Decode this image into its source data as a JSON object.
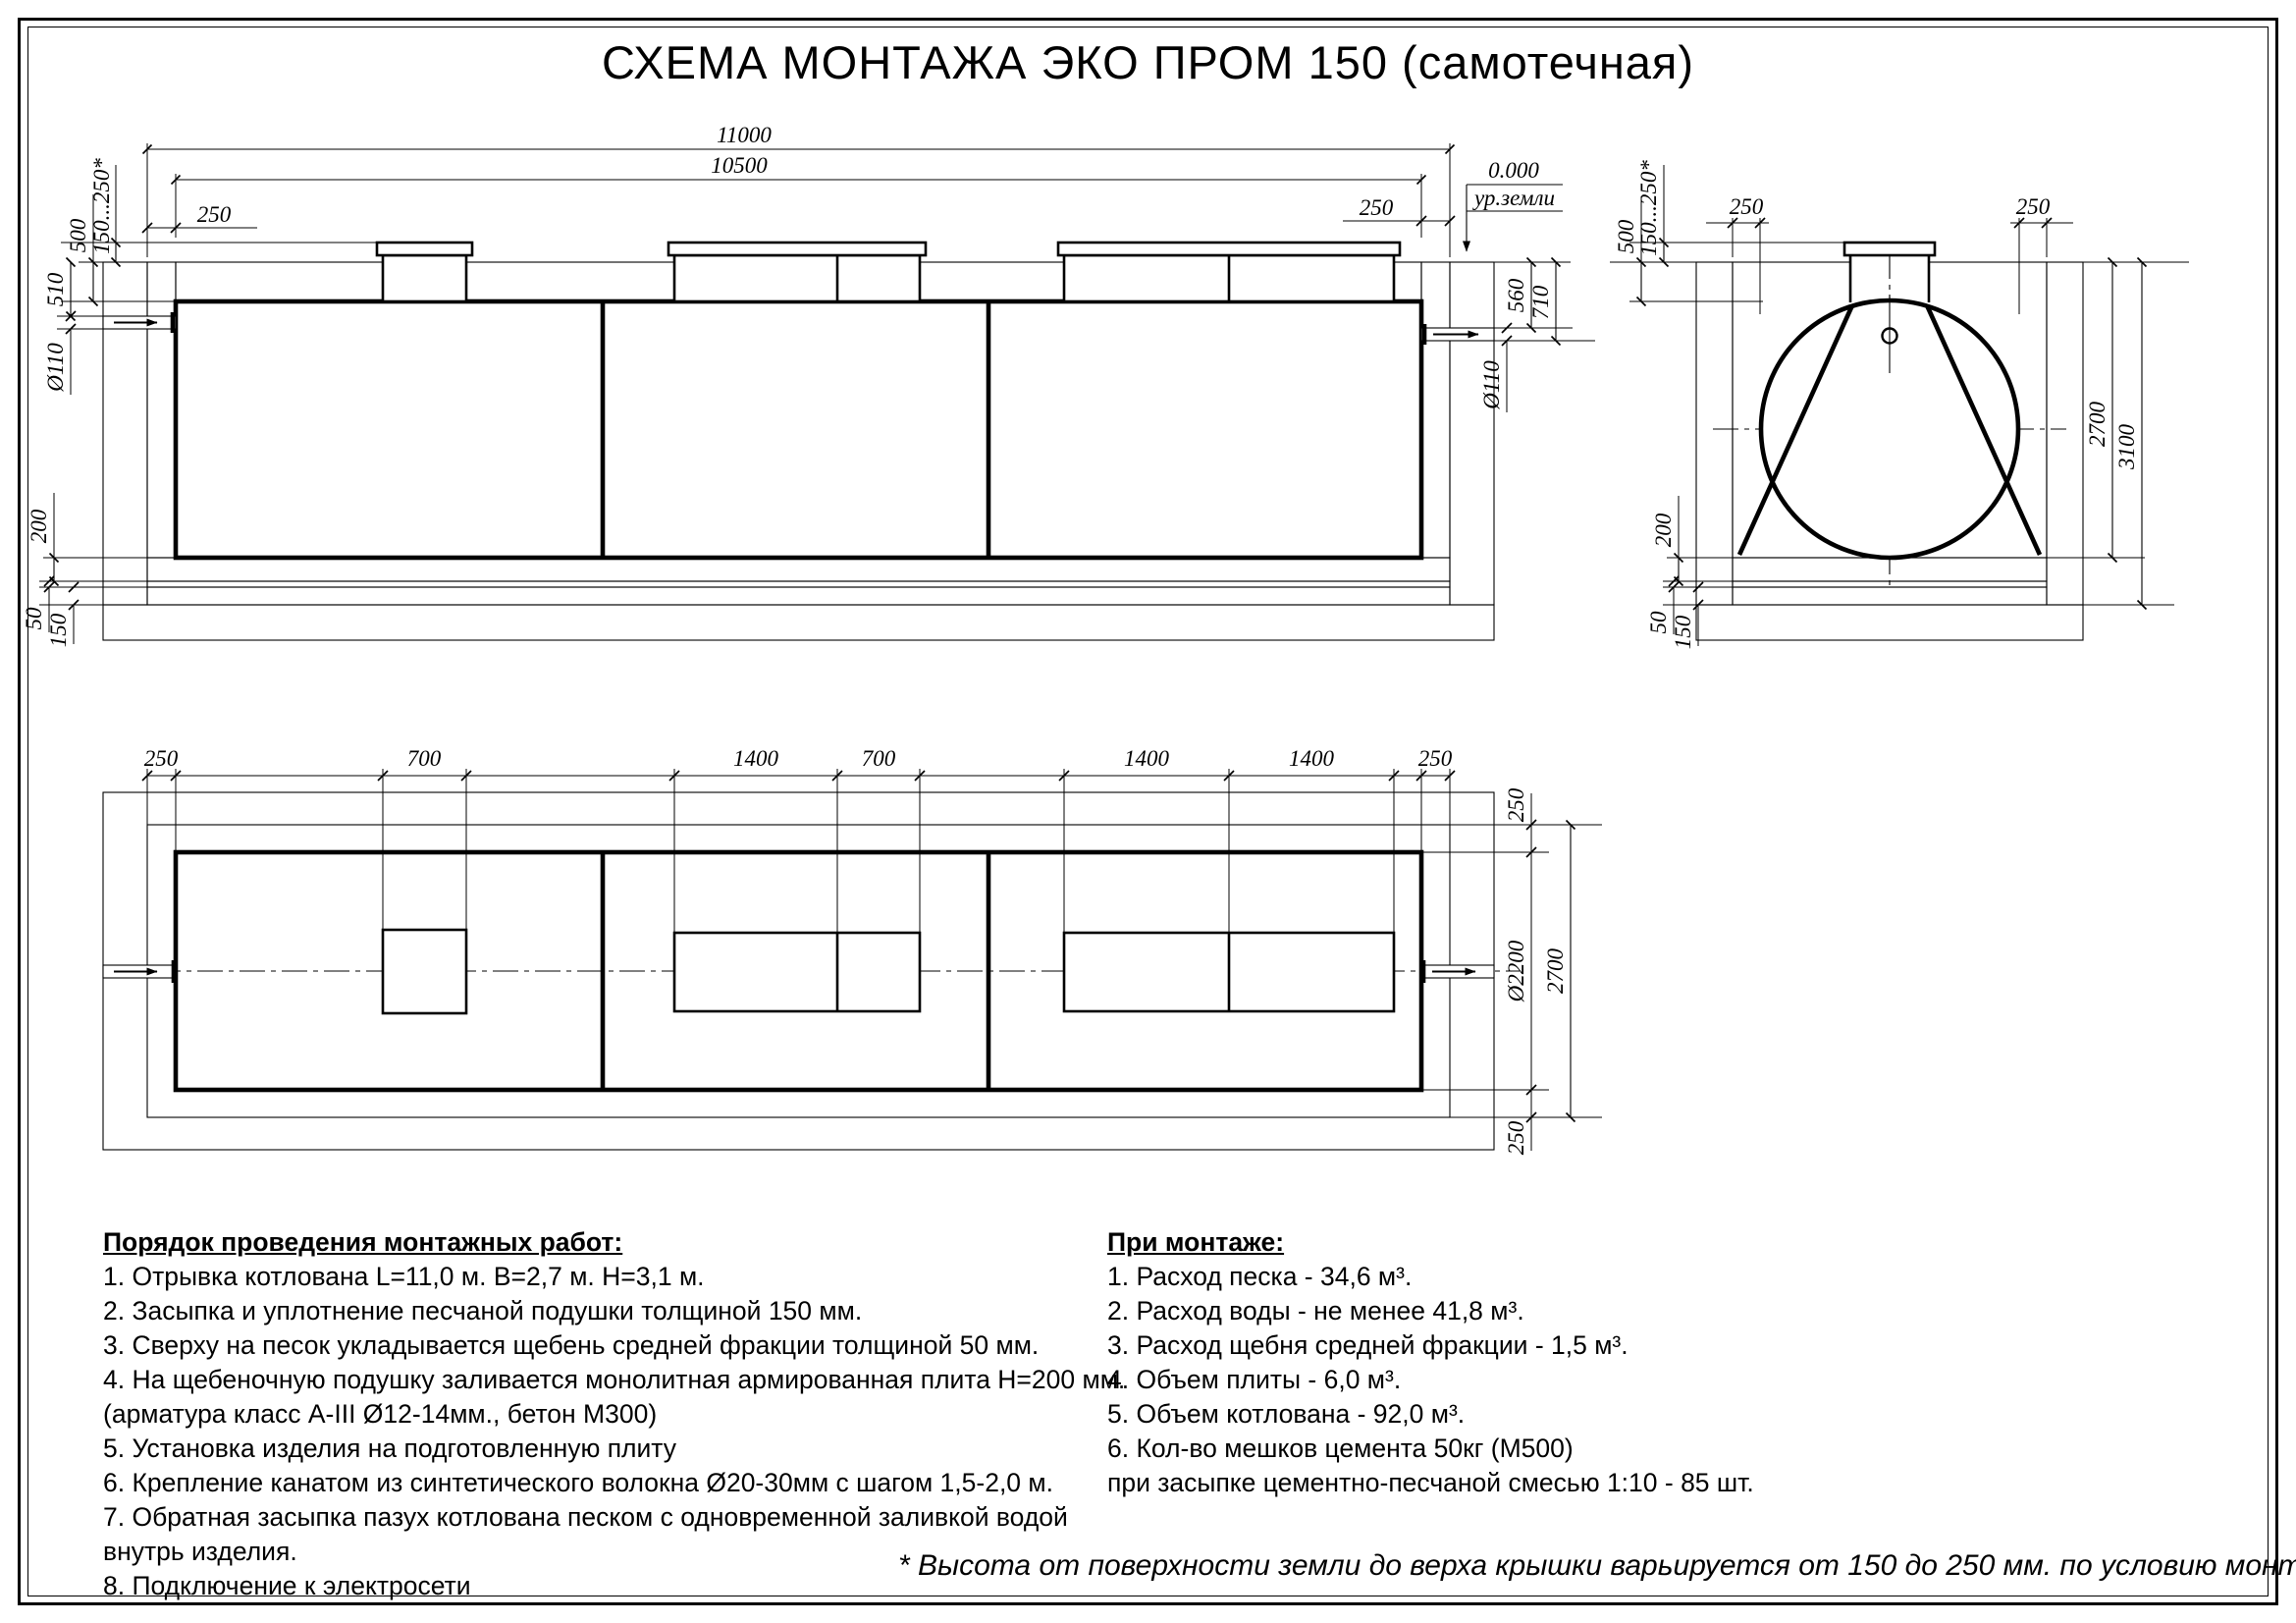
{
  "title": "СХЕМА МОНТАЖА ЭКО ПРОМ 150 (самотечная)",
  "drawing_labels": {
    "d11000": "11000",
    "d10500": "10500",
    "d250": "250",
    "d500": "500",
    "d150_250": "150...250*",
    "d510": "510",
    "d_o110": "Ø110",
    "d200": "200",
    "d50": "50",
    "d150": "150",
    "d560": "560",
    "d710": "710",
    "zero_mark": "0.000",
    "ground_mark": "ур.земли",
    "d700": "700",
    "d1400": "1400",
    "d_o2200": "Ø2200",
    "d2700": "2700",
    "d3100": "3100"
  },
  "install_steps": {
    "heading": "Порядок проведения монтажных работ:",
    "lines": [
      "1. Отрывка котлована L=11,0 м. B=2,7 м. H=3,1 м.",
      "2. Засыпка и уплотнение песчаной подушки толщиной 150 мм.",
      "3. Сверху на песок укладывается щебень средней фракции толщиной 50 мм.",
      "4. На щебеночную подушку заливается монолитная армированная плита H=200 мм.",
      "(арматура класс А-III Ø12-14мм., бетон М300)",
      "5. Установка изделия на подготовленную плиту",
      "6. Крепление канатом из синтетического волокна Ø20-30мм с шагом 1,5-2,0 м.",
      "7. Обратная засыпка пазух котлована песком с одновременной заливкой водой",
      "внутрь изделия.",
      "8. Подключение к электросети"
    ]
  },
  "install_specs": {
    "heading": "При монтаже:",
    "lines": [
      "1. Расход песка - 34,6 м³.",
      "2. Расход воды - не менее 41,8 м³.",
      "3. Расход щебня средней фракции - 1,5 м³.",
      "4. Объем плиты - 6,0 м³.",
      "5. Объем котлована - 92,0 м³.",
      "6. Кол-во мешков цемента 50кг (М500)",
      "при засыпке цементно-песчаной смесью 1:10 - 85 шт."
    ]
  },
  "footnote": "* Высота от поверхности земли до верха крышки варьируется от 150 до 250 мм. по условию монтажа"
}
